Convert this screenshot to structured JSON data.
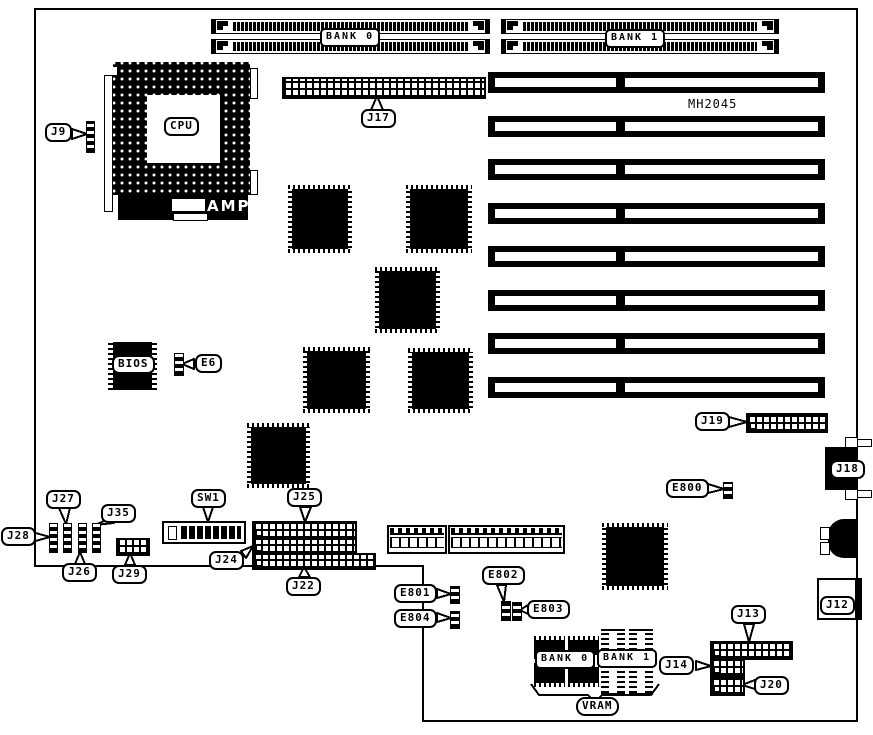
{
  "diagram_title": "System board component location diagram",
  "colors": {
    "ink": "#000000",
    "paper": "#ffffff"
  },
  "labels": {
    "bank0_top": "BANK 0",
    "bank1_top": "BANK 1",
    "mh2045": "MH2045",
    "cpu": "CPU",
    "amp": "AMP",
    "bios": "BIOS",
    "e6": "E6",
    "j9": "J9",
    "j17": "J17",
    "j19": "J19",
    "j18": "J18",
    "e800": "E800",
    "j27": "J27",
    "j35": "J35",
    "j28": "J28",
    "j26": "J26",
    "j29": "J29",
    "sw1": "SW1",
    "j24": "J24",
    "j25": "J25",
    "j22": "J22",
    "e801": "E801",
    "e804": "E804",
    "e802": "E802",
    "e803": "E803",
    "j12": "J12",
    "j13": "J13",
    "j14": "J14",
    "j20": "J20",
    "vram_bank0": "BANK 0",
    "vram_bank1": "BANK 1",
    "vram": "VRAM"
  }
}
